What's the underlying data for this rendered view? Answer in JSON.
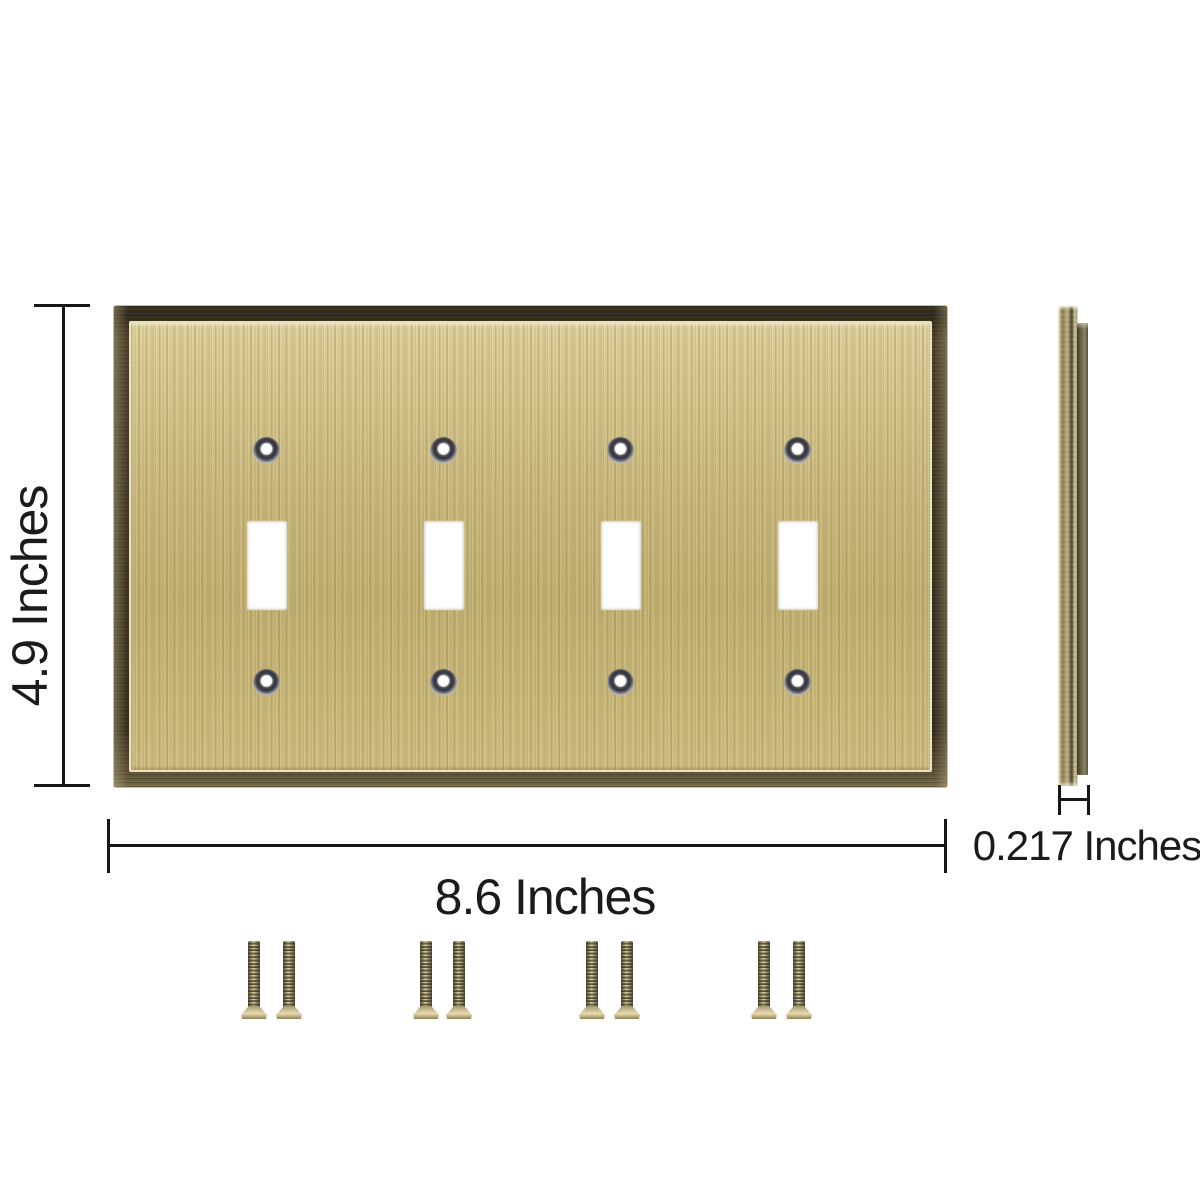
{
  "image_type": "product-dimension-diagram",
  "product": {
    "name_hint": "toggle-switch-wall-plate",
    "front_view": {
      "gang_count": 4,
      "toggle_cutout_count": 4,
      "screw_hole_count": 8
    },
    "side_view": {
      "shows": "plate-edge-profile"
    },
    "hardware": {
      "screw_count": 8,
      "screw_pair_count": 4
    }
  },
  "dimensions": {
    "height_label": "4.9 Inches",
    "width_label": "8.6 Inches",
    "depth_label": "0.217 Inches"
  },
  "colors": {
    "background": "#ffffff",
    "brass_face": "#c9b77a",
    "brass_face_light": "#ddd099",
    "frame_dark_bronze": "#3c3522",
    "frame_rim_light": "#cfc08e",
    "screw_hole_ring": "#2f2f36",
    "screw_thread_dark": "#453e2a",
    "screw_head_light": "#d9cca0",
    "dimension_line": "#161616",
    "label_text": "#1b1b1b"
  }
}
